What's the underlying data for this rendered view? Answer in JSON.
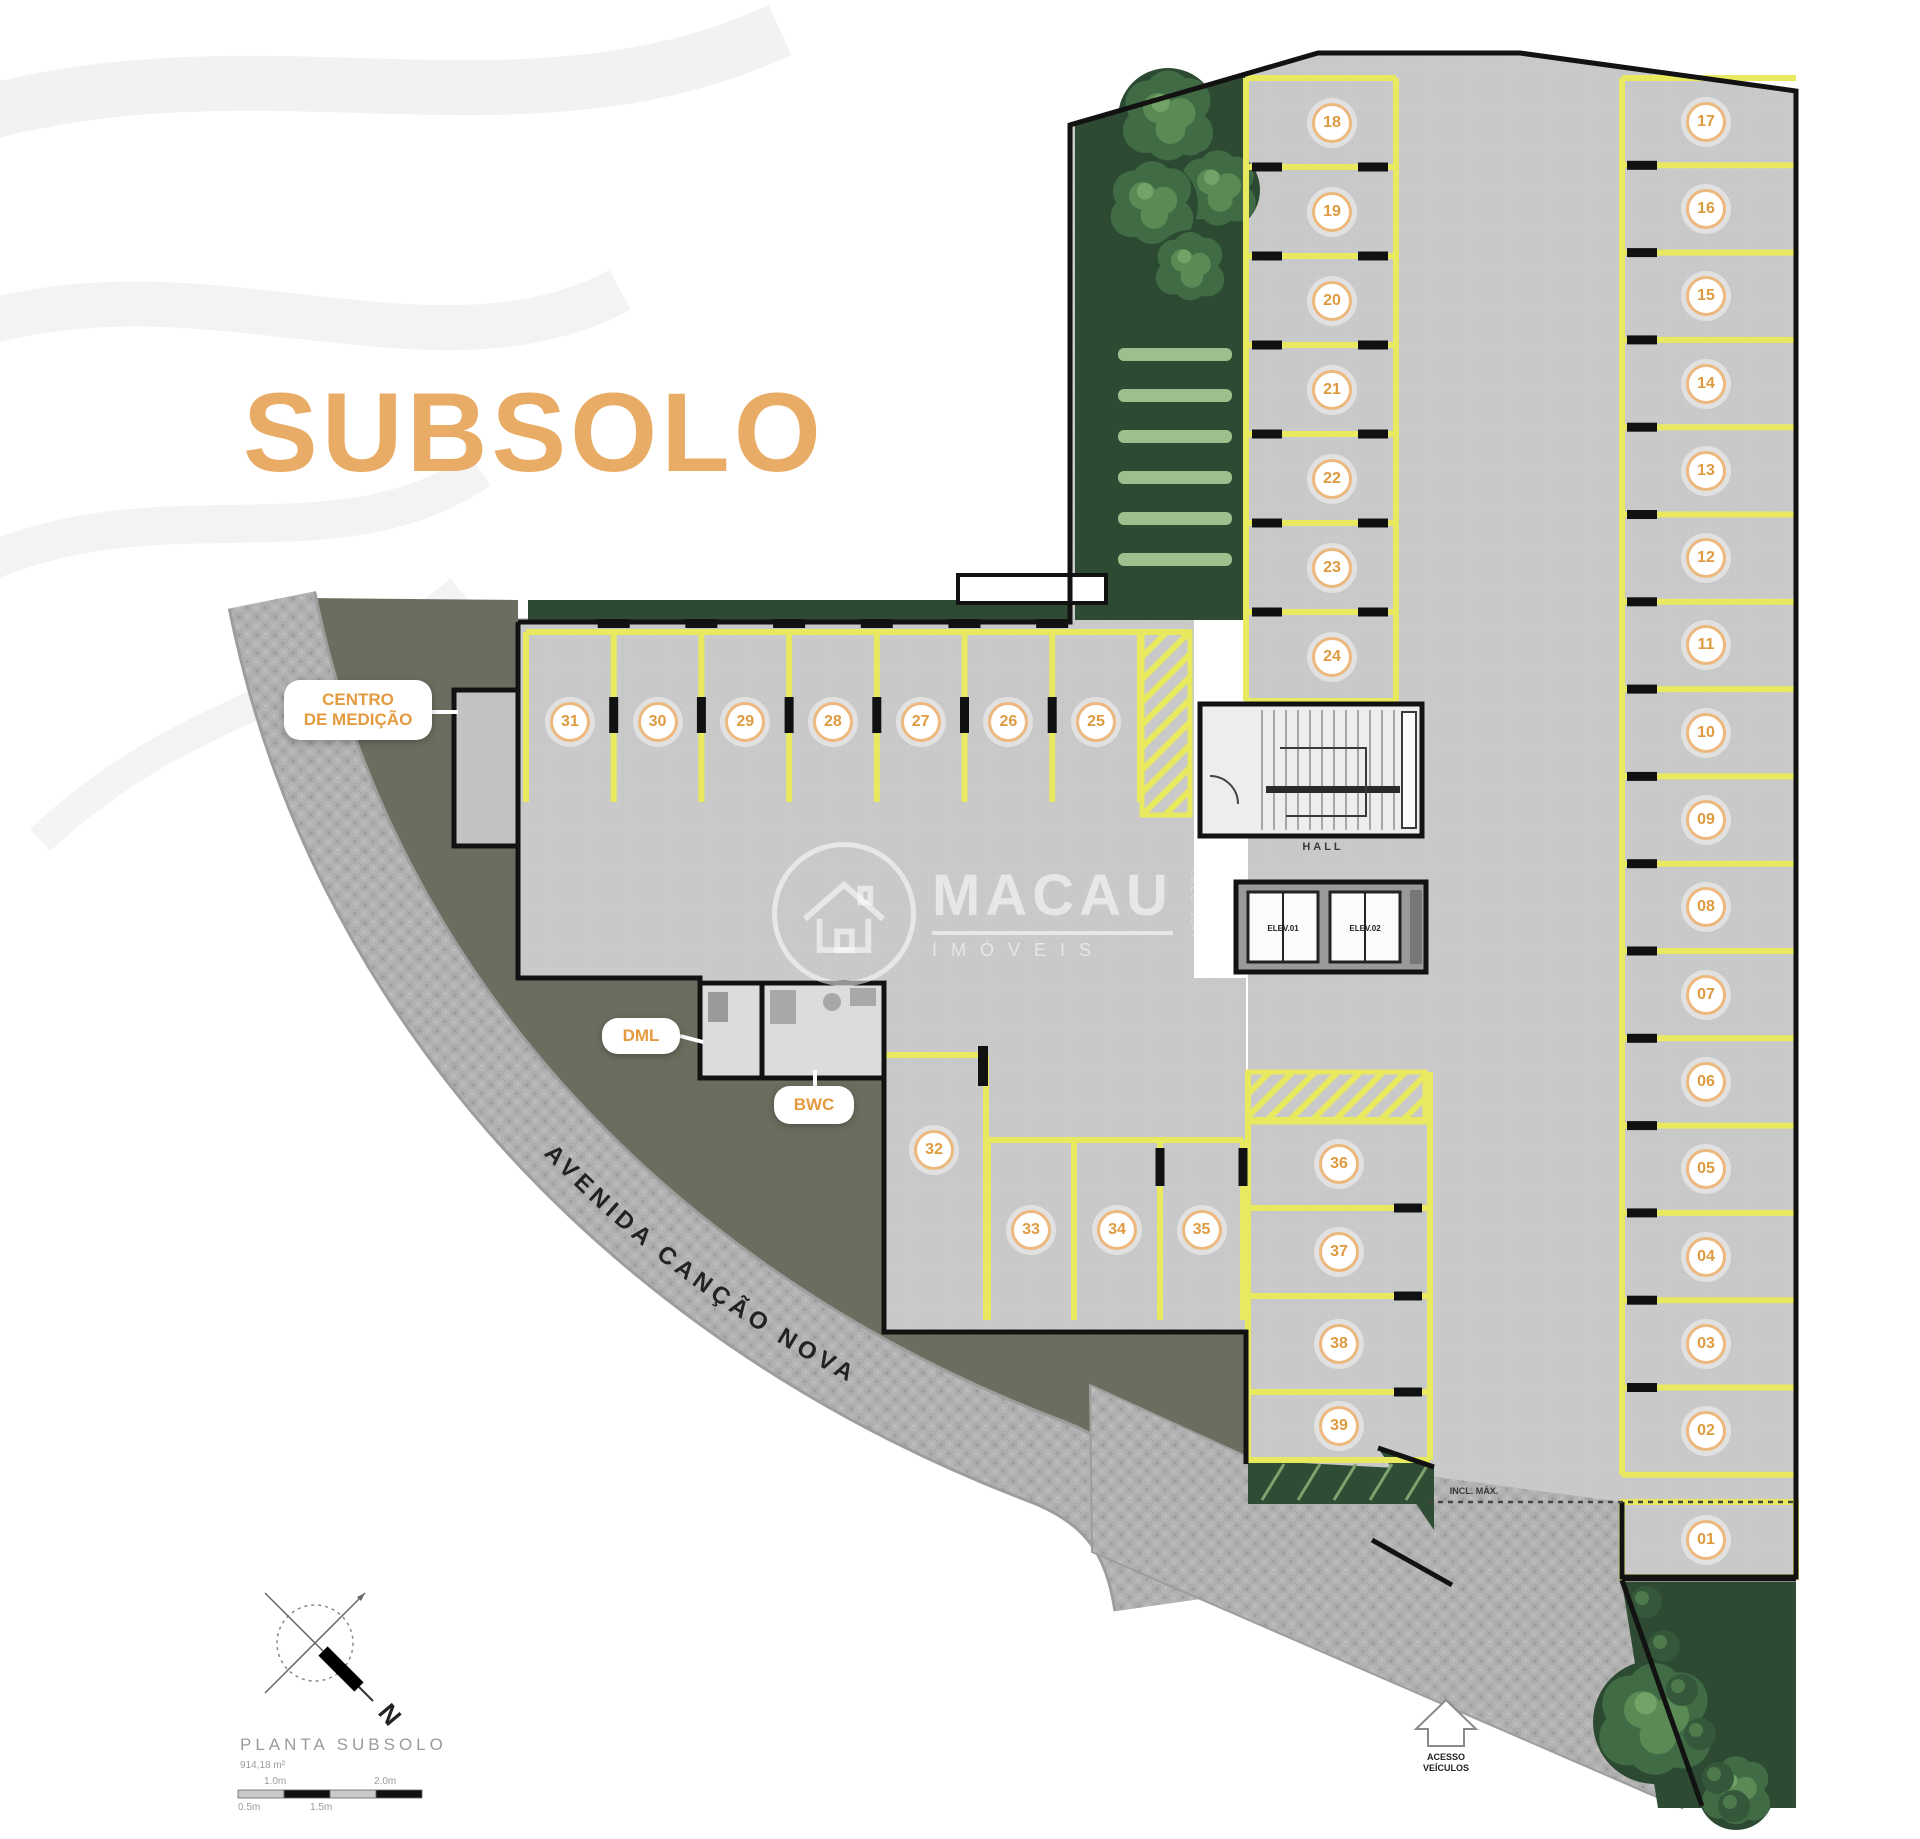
{
  "title": "SUBSOLO",
  "colors": {
    "accent_orange": "#E9AC67",
    "marking_yellow": "#E8E95E",
    "floor_gray": "#C9C9C9",
    "ground_olive": "#6D6D5F"
  },
  "plan": {
    "street": "AVENIDA CANÇÃO NOVA",
    "hall": "HALL",
    "elevators": [
      "ELEV.01",
      "ELEV.02"
    ],
    "rooms": {
      "centro_line1": "CENTRO",
      "centro_line2": "DE MEDIÇÃO",
      "dml": "DML",
      "bwc": "BWC"
    },
    "ramp_note": "INCL. MÁX.",
    "access_line1": "ACESSO",
    "access_line2": "VEÍCULOS",
    "spots": {
      "row_top": [
        "31",
        "30",
        "29",
        "28",
        "27",
        "26",
        "25"
      ],
      "col_mid": [
        "18",
        "19",
        "20",
        "21",
        "22",
        "23",
        "24"
      ],
      "col_right": [
        "17",
        "16",
        "15",
        "14",
        "13",
        "12",
        "11",
        "10",
        "09",
        "08",
        "07",
        "06",
        "05",
        "04",
        "03",
        "02"
      ],
      "col_bottom": [
        "36",
        "37",
        "38",
        "39"
      ],
      "row_bottom": [
        "33",
        "34",
        "35"
      ],
      "single_mid": "32",
      "single_corner": "01"
    }
  },
  "watermark": {
    "brand": "MACAU",
    "subtitle": "IMÓVEIS",
    "registration": "CRECI 9547"
  },
  "legend": {
    "plan_name": "PLANTA SUBSOLO",
    "area": "914,18 m²",
    "north": "N",
    "scale_top": [
      "1.0m",
      "2.0m"
    ],
    "scale_bottom": [
      "0.5m",
      "1.5m"
    ]
  }
}
